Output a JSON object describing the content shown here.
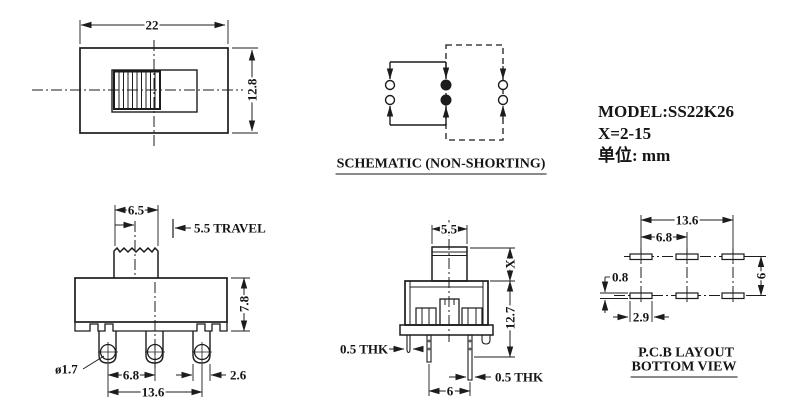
{
  "title_block": {
    "model": "MODEL:SS22K26",
    "x_range": "X=2-15",
    "unit": "单位: mm"
  },
  "top_view": {
    "dim_width": "22",
    "dim_height": "12.8"
  },
  "schematic": {
    "caption": "SCHEMATIC (NON-SHORTING)"
  },
  "front_view": {
    "dim_knob_width": "6.5",
    "dim_travel": "5.5 TRAVEL",
    "dim_body_height": "7.8",
    "dim_hole_diameter": "ø1.7",
    "dim_pin_pitch": "6.8",
    "dim_pin_span": "13.6",
    "dim_terminal_width": "2.6"
  },
  "side_view": {
    "dim_knob_width": "5.5",
    "dim_actuator_height": "X",
    "dim_body_height": "12.7",
    "dim_thickness_left": "0.5 THK",
    "dim_thickness_right": "0.5 THK",
    "dim_pin_pitch": "6"
  },
  "pcb_view": {
    "caption_line1": "P.C.B LAYOUT",
    "caption_line2": "BOTTOM VIEW",
    "dim_span": "13.6",
    "dim_pitch": "6.8",
    "dim_pad_height": "0.8",
    "dim_pad_width": "2.9",
    "dim_row_pitch": "6"
  },
  "colors": {
    "line": "#1c1c1c",
    "background": "#ffffff"
  }
}
